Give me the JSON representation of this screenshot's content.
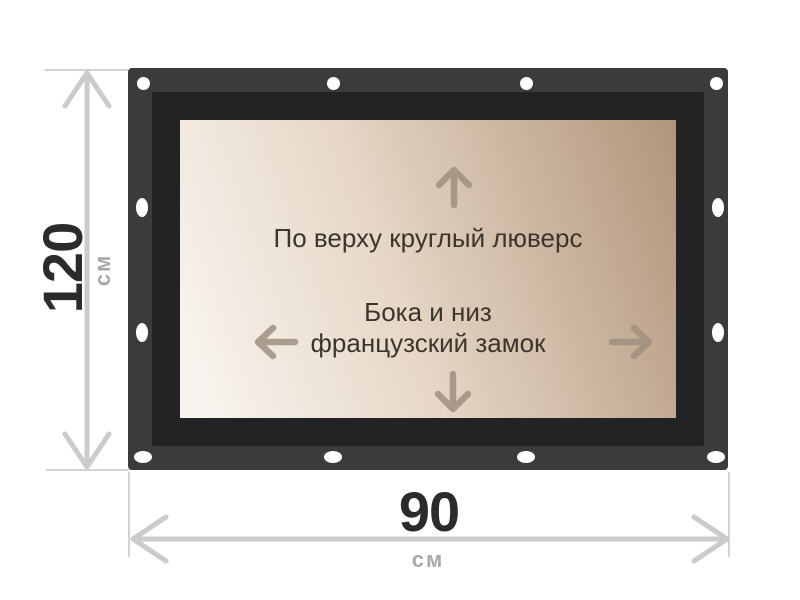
{
  "panel": {
    "top_note": "По верху круглый люверс",
    "center_note_line1": "Бока и низ",
    "center_note_line2": "французский замок"
  },
  "dimensions": {
    "height": {
      "value": "120",
      "unit": "см"
    },
    "width": {
      "value": "90",
      "unit": "см"
    }
  },
  "icons": {
    "panel_arrows": [
      "up-arrow",
      "left-arrow",
      "right-arrow",
      "down-arrow"
    ],
    "dimension_arrows": [
      "double-arrow-vertical",
      "double-arrow-horizontal"
    ]
  },
  "colors": {
    "frame": "#3b3b3d",
    "frame_inner_border": "#232325",
    "panel_gradient_light": "#f8f4ef",
    "panel_gradient_dark": "#b1957a",
    "grommet": "#ffffff",
    "panel_arrow": "#a09080",
    "panel_text": "#3b352d",
    "dimension_line": "#cbcbcb",
    "dimension_value_text": "#2b2b2d",
    "dimension_unit_text": "#a9a9a9"
  },
  "grommet_count": 12
}
